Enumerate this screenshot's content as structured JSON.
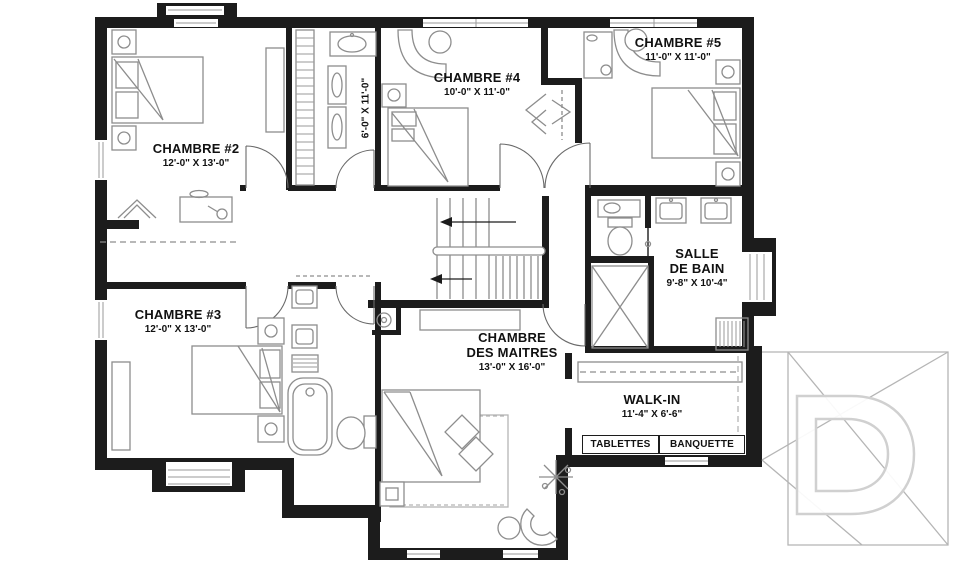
{
  "plan": {
    "rooms": [
      {
        "id": "chambre-2",
        "name": "CHAMBRE #2",
        "dims": "12'-0\" X 13'-0\""
      },
      {
        "id": "chambre-3",
        "name": "CHAMBRE #3",
        "dims": "12'-0\" X 13'-0\""
      },
      {
        "id": "chambre-4",
        "name": "CHAMBRE #4",
        "dims": "10'-0\" X 11'-0\""
      },
      {
        "id": "chambre-5",
        "name": "CHAMBRE #5",
        "dims": "11'-0\" X 11'-0\""
      },
      {
        "id": "chambre-des-maitres",
        "name_line1": "CHAMBRE",
        "name_line2": "DES MAITRES",
        "dims": "13'-0\" X 16'-0\""
      },
      {
        "id": "salle-de-bain",
        "name_line1": "SALLE",
        "name_line2": "DE BAIN",
        "dims": "9'-8\" X 10'-4\""
      },
      {
        "id": "walk-in",
        "name": "WALK-IN",
        "dims": "11'-4\" X 6'-6\""
      },
      {
        "id": "salle-de-bain-etage",
        "dims": "6'-0\" X 11'-0\""
      }
    ],
    "walkin_features": {
      "tablettes": "TABLETTES",
      "banquette": "BANQUETTE"
    },
    "colors": {
      "wall": "#1c1c1c",
      "furniture": "#8d8d8d",
      "light_lines": "#b5b5b5",
      "watermark": "#d0d0d0",
      "text": "#111111",
      "background": "#ffffff"
    }
  }
}
